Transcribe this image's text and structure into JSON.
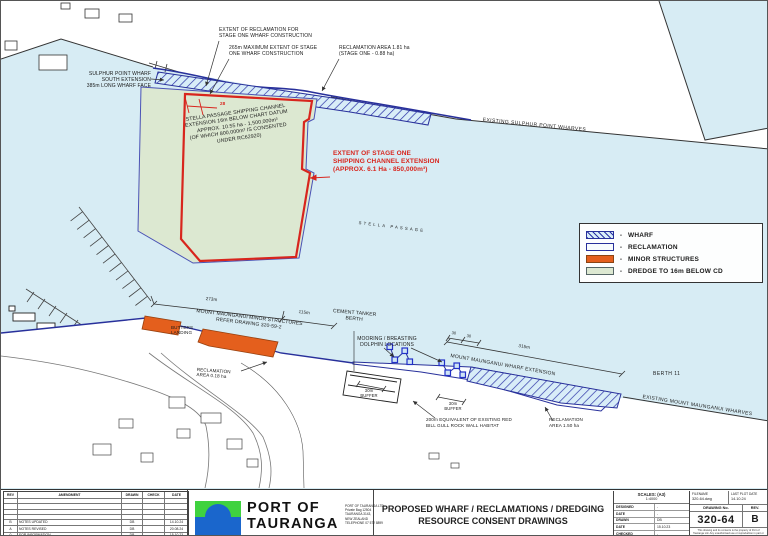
{
  "colors": {
    "water": "#d7ecf4",
    "land": "#ffffff",
    "dredge_green": "#dce8d1",
    "wharf_hatch_blue": "#2b33a6",
    "minor_structures_orange": "#e45f1d",
    "stage_one_red": "#d8251d",
    "navy_outline": "#28309b"
  },
  "map": {
    "labels": {
      "sulphur_wharf": "SULPHUR POINT WHARF\nSOUTH EXTENSION\n385m LONG WHARF FACE",
      "extent_reclamation": "EXTENT OF RECLAMATION FOR\nSTAGE ONE WHARF CONSTRUCTION",
      "max_extent": "265m MAXIMUM EXTENT OF STAGE\nONE WHARF CONSTRUCTION",
      "reclamation_181": "RECLAMATION AREA 1.81 ha\n(STAGE ONE - 0.88 ha)",
      "existing_sulphur": "EXISTING SULPHUR POINT WHARVES",
      "dredge_note": "STELLA PASSAGE SHIPPING CHANNEL\nEXTENSION 16m BELOW CHART DATUM\nAPPROX. 10.55 ha - 1,500,000m³\n(OF WHICH 800,000m³ IS CONSENTED\nUNDER RC62920)",
      "stage_one": "EXTENT OF STAGE ONE\nSHIPPING CHANNEL EXTENSION\n(APPROX. 6.1 Ha - 850,000m³)",
      "dim_28": "28",
      "stella": "STELLA PASSAGE",
      "dim_273": "273m",
      "minor_structures": "MOUNT MAUNGANUI MINOR STRUCTURES\nREFER DRAWING 320-59-2",
      "dim_115": "115m",
      "cement_tanker": "CEMENT TANKER\nBERTH",
      "butters": "BUTTERS\nLANDING",
      "reclamation_018": "RECLAMATION\nAREA 0.18 ha",
      "mooring": "MOORING / BREASTING\nDOLPHIN LOCATIONS",
      "dim_30a": "30",
      "dim_30b": "30",
      "dim_315": "315m",
      "wharf_extension": "MOUNT MAUNGANUI WHARF EXTENSION",
      "berth_11": "BERTH 11",
      "existing_mm": "EXISTING MOUNT MAUNGANUI WHARVES",
      "buffer_a": "30m\nBUFFER",
      "buffer_b": "30m\nBUFFER",
      "red_bill": "200m EQUIVALENT OF EXISTING RED\nBILL GULL ROCK WALL HABITAT",
      "reclamation_150": "RECLAMATION\nAREA 1.50 ha"
    }
  },
  "legend": {
    "dash": "-",
    "items": [
      {
        "swatch": "wharf-hatch",
        "label": "WHARF"
      },
      {
        "swatch": "reclamation",
        "label": "RECLAMATION"
      },
      {
        "swatch": "minor-structures",
        "label": "MINOR STRUCTURES"
      },
      {
        "swatch": "dredge",
        "label": "DREDGE TO 16m BELOW CD"
      }
    ]
  },
  "title_block": {
    "revision_table": {
      "headers": [
        "REV",
        "AMENDMENT",
        "DRAWN",
        "CHECK",
        "DATE"
      ],
      "rows": [
        {
          "rev": "B",
          "amendment": "NOTES UPDATED",
          "drawn": "DB",
          "check": "",
          "date": "14.10.24"
        },
        {
          "rev": "A",
          "amendment": "NOTES REVISED",
          "drawn": "DB",
          "check": "",
          "date": "20.08.24"
        },
        {
          "rev": "0",
          "amendment": "FOR INFORMATION",
          "drawn": "DB",
          "check": "",
          "date": "15.10.23"
        }
      ]
    },
    "company": {
      "name": "PORT OF\nTAURANGA",
      "address": "PORT OF TAURANGA LTD.\nPrivate Bag 12504\nTAURANGA 3143,\nNEW ZEALAND\nTELEPHONE 07 572 8899"
    },
    "title": "PROPOSED WHARF / RECLAMATIONS / DREDGING\nRESOURCE CONSENT DRAWINGS",
    "scales": {
      "label": "SCALES: (A3)",
      "value": "1:4000",
      "fields": [
        {
          "label": "DESIGNED",
          "value": "-"
        },
        {
          "label": "DATE",
          "value": "-"
        },
        {
          "label": "DRAWN",
          "value": "DB"
        },
        {
          "label": "DATE",
          "value": "15.10.23"
        },
        {
          "label": "CHECKED",
          "value": "-"
        },
        {
          "label": "DATE",
          "value": ""
        }
      ]
    },
    "file": {
      "filename_label": "FILENAME",
      "filename": "320-64.dwg",
      "plot_label": "LAST PLOT DATE",
      "plot_date": "14.10.24",
      "drawing_no_label": "DRAWING No.",
      "drawing_no": "320-64",
      "rev_label": "REV.",
      "rev": "B",
      "disclaimer": "This drawing and its contents is the property of Port of Tauranga Ltd. Any unauthorised use or reproduction in part or in full is forbidden."
    }
  }
}
